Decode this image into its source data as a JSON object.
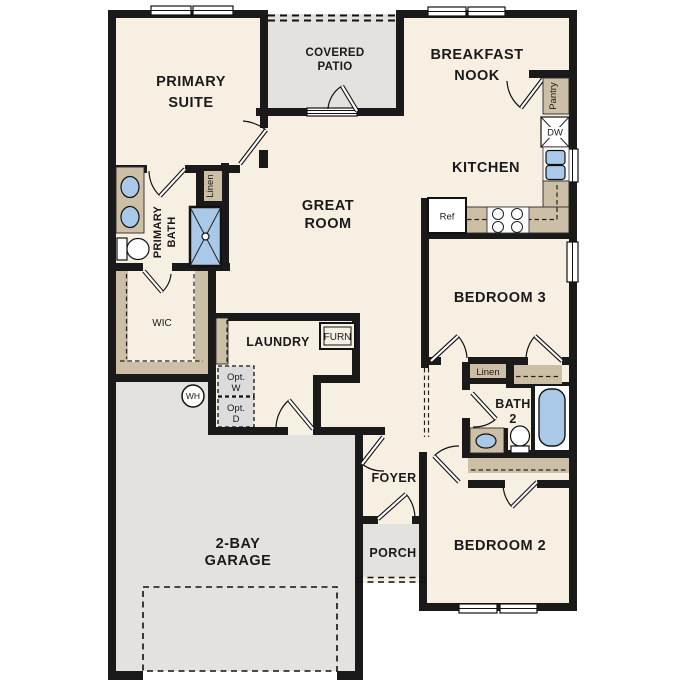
{
  "colors": {
    "wall_black": "#1a1a1a",
    "room_fill_cream": "#f7efe2",
    "concrete_gray": "#e3e2df",
    "casework_tan": "#cdbfa5",
    "fixture_blue": "#aac9e8",
    "window_white": "#ffffff"
  },
  "rooms": {
    "primary_suite": {
      "line1": "PRIMARY",
      "line2": "SUITE"
    },
    "covered_patio": {
      "line1": "COVERED",
      "line2": "PATIO"
    },
    "breakfast_nook": {
      "line1": "BREAKFAST",
      "line2": "NOOK"
    },
    "kitchen": {
      "label": "KITCHEN"
    },
    "great_room": {
      "line1": "GREAT",
      "line2": "ROOM"
    },
    "primary_bath": {
      "line1": "PRIMARY",
      "line2": "BATH"
    },
    "wic": {
      "label": "WIC"
    },
    "laundry": {
      "label": "LAUNDRY"
    },
    "bedroom3": {
      "label": "BEDROOM 3"
    },
    "bath2": {
      "line1": "BATH",
      "line2": "2"
    },
    "bedroom2": {
      "label": "BEDROOM 2"
    },
    "foyer": {
      "label": "FOYER"
    },
    "porch": {
      "label": "PORCH"
    },
    "garage": {
      "line1": "2-BAY",
      "line2": "GARAGE"
    }
  },
  "callouts": {
    "linen_primary": "Linen",
    "linen_hall": "Linen",
    "pantry": "Pantry",
    "dishwasher": "DW",
    "refrigerator": "Ref",
    "furnace": "FURN",
    "water_heater": "WH",
    "optional_washer": {
      "line1": "Opt.",
      "line2": "W"
    },
    "optional_dryer": {
      "line1": "Opt.",
      "line2": "D"
    }
  }
}
